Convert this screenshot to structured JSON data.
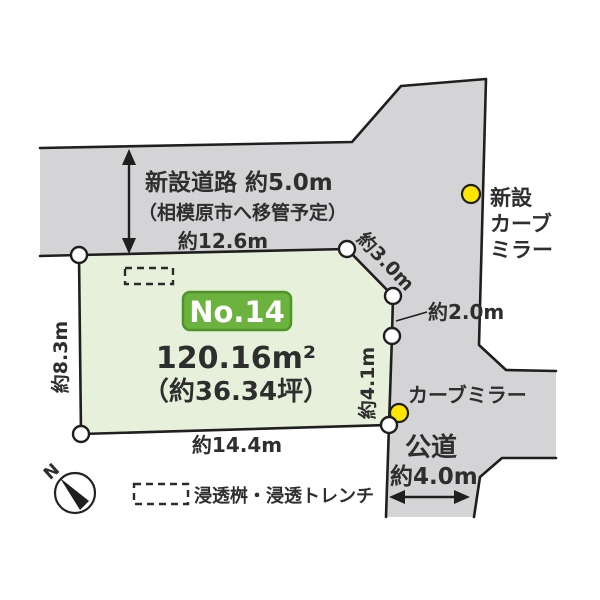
{
  "colors": {
    "road_fill": "#d4d4d6",
    "lot_fill": "#e7f0da",
    "badge_fill": "#6cb23e",
    "badge_border": "#4f9429",
    "marker_yellow": "#ffe600"
  },
  "roads": {
    "new_road": {
      "name": "新設道路 約5.0m",
      "note": "（相模原市へ移管予定）"
    },
    "public_road": {
      "name": "公道",
      "width": "約4.0m"
    }
  },
  "lot": {
    "number": "No.14",
    "area_m2": "120.16m²",
    "area_tsubo": "（約36.34坪）",
    "dimensions": {
      "top": "約12.6m",
      "left": "約8.3m",
      "bottom": "約14.4m",
      "diagonal": "約3.0m",
      "right_upper": "約2.0m",
      "right_lower": "約4.1m"
    }
  },
  "markers": {
    "new_curve_mirror": {
      "label_lines": [
        "新設",
        "カーブ",
        "ミラー"
      ]
    },
    "curve_mirror": {
      "label": "カーブミラー"
    }
  },
  "legend": {
    "infiltration": "浸透桝・浸透トレンチ"
  },
  "compass": {
    "label": "N"
  }
}
